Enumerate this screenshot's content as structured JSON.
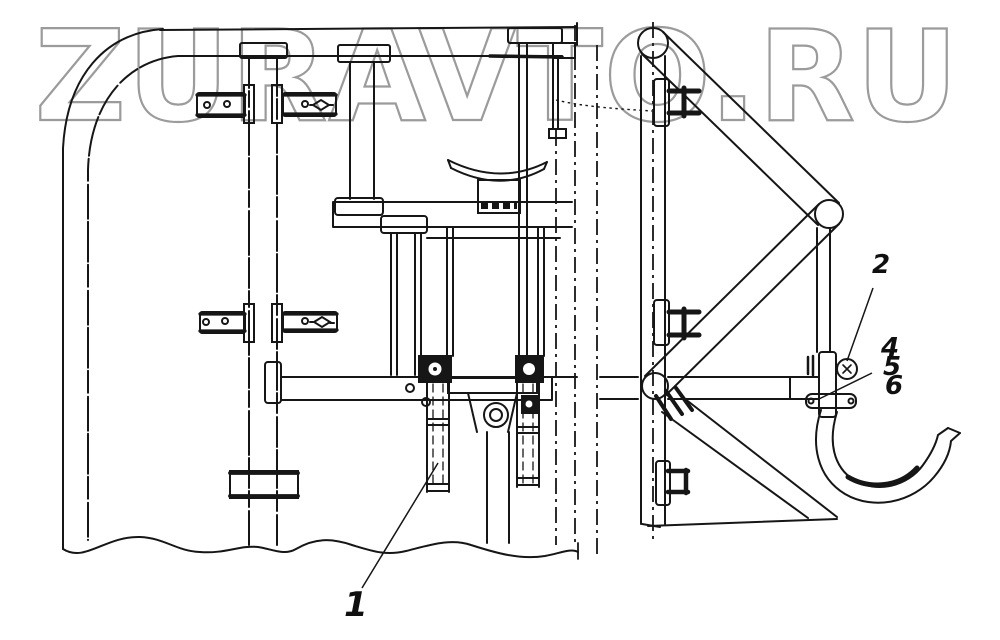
{
  "watermark": {
    "text": "ZURAVTO.RU",
    "outline_color": "#9b9b9b"
  },
  "colors": {
    "ink": "#161616",
    "background": "#ffffff"
  },
  "callouts": [
    {
      "label": "1"
    },
    {
      "label": "2"
    },
    {
      "label": "4"
    },
    {
      "label": "5"
    },
    {
      "label": "6"
    }
  ]
}
